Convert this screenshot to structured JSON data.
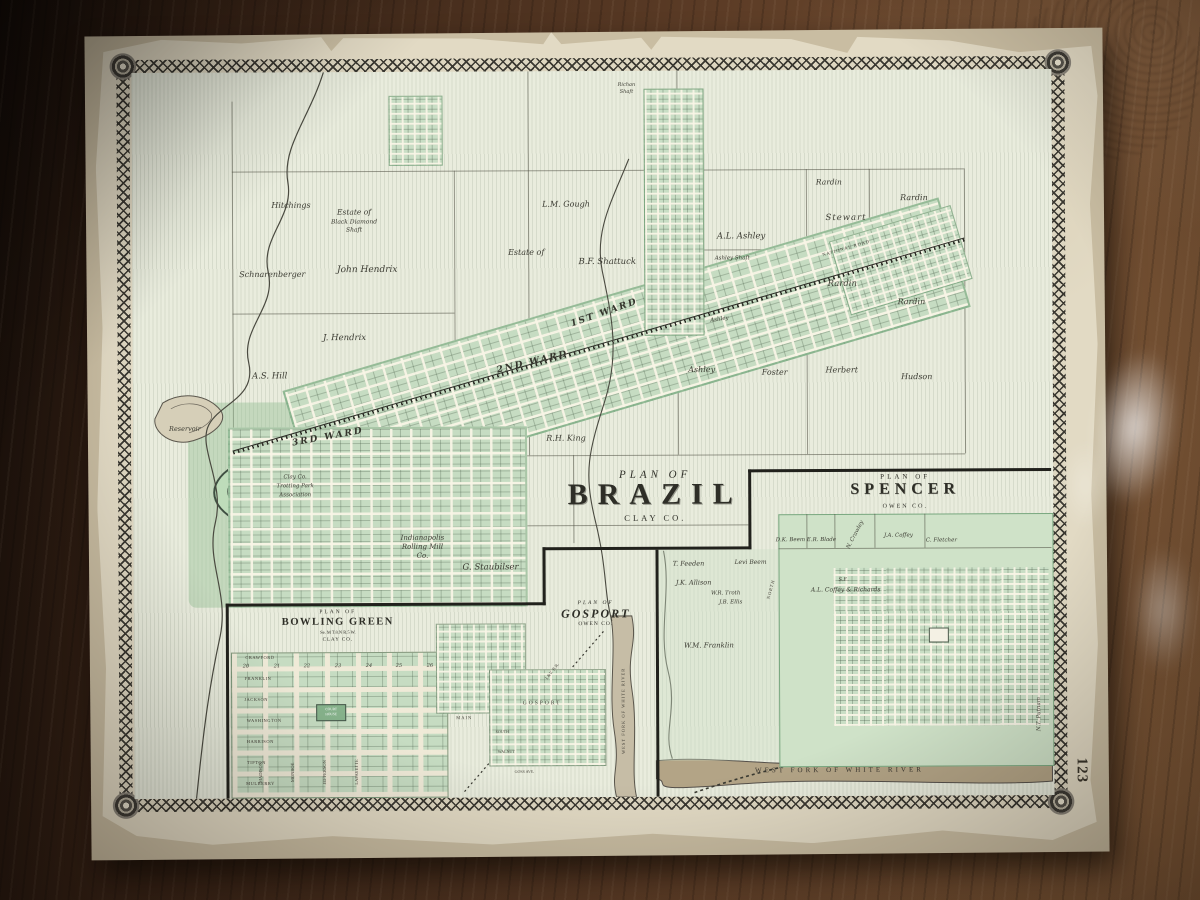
{
  "photo": {
    "page_number": "123"
  },
  "brazil": {
    "title_small": "PLAN OF",
    "title": "BRAZIL",
    "county": "CLAY CO.",
    "road": "NATIONAL ROAD",
    "wards": {
      "first": "1ST WARD",
      "second": "2ND WARD",
      "third": "3RD WARD"
    },
    "parcels": {
      "hitchings": "Hitchings",
      "estate1": "Estate of",
      "estate2": "Black Diamond",
      "estate3": "Shaft",
      "schnarenberger": "Schnarenberger",
      "john_hendrix": "John Hendrix",
      "j_hendrix": "J. Hendrix",
      "as_hill": "A.S. Hill",
      "lm_gough": "L.M. Gough",
      "estate_of": "Estate of",
      "bf_shattuck": "B.F. Shattuck",
      "al_ashley": "A.L. Ashley",
      "ashley_shaft": "Ashley Shaft",
      "ashley_road": "Ashley",
      "rardin_a": "Rardin",
      "rardin_b": "Rardin",
      "stewart": "Stewart",
      "rardin_c": "Rardin",
      "rardin_d": "Rardin",
      "ashley": "Ashley",
      "foster": "Foster",
      "herbert": "Herbert",
      "hudson": "Hudson",
      "rh_king": "R.H. King",
      "staubilser": "G. Staubilser"
    },
    "features": {
      "reservoir": "Reservoir",
      "trotting1": "Clay Co.",
      "trotting2": "Trotting Park",
      "trotting3": "Association",
      "mill1": "Indianapolis",
      "mill2": "Rolling Mill",
      "mill3": "Co.",
      "richan1": "Richan",
      "richan2": "Shaft"
    }
  },
  "spencer": {
    "title_small": "PLAN OF",
    "title": "SPENCER",
    "county": "OWEN CO.",
    "owners": {
      "dk_beem": "D.K. Beem",
      "er_blade": "E.R. Blade",
      "n_crawley": "N. Crawley",
      "ja_coffey": "J.A. Coffey",
      "c_fletcher": "C. Fletcher",
      "t_feeden": "T. Feeden",
      "levi_beem": "Levi Beem",
      "jk_allison": "J.K. Allison",
      "wr_troth": "W.R. Troth",
      "jb_ellis": "J.B. Ellis",
      "se": "S.E.",
      "coffey_richards": "A.L. Coffey & Richards",
      "wm_franklin": "W.M. Franklin",
      "nt_putnam": "N.T. Putnam"
    },
    "street_north": "NORTH",
    "river": "WEST FORK OF WHITE RIVER"
  },
  "bowling_green": {
    "title_small": "PLAN OF",
    "title": "BOWLING GREEN",
    "township": "Se. M T.8.N R.5 W.",
    "county": "CLAY CO.",
    "streets_h": [
      "CRAWFORD",
      "FRANKLIN",
      "JACKSON",
      "WASHINGTON",
      "HARRISON",
      "TIPTON",
      "MULBERRY"
    ],
    "streets_v": [
      "MADISON",
      "MONROE",
      "JEFFERSON",
      "LAFAYETTE"
    ],
    "blocks": [
      "20",
      "21",
      "22",
      "23",
      "24",
      "25",
      "26"
    ],
    "courthouse1": "COURT",
    "courthouse2": "HOUSE"
  },
  "gosport": {
    "title_small": "PLAN OF",
    "title": "GOSPORT",
    "county": "OWEN CO.",
    "label": "GOSPORT",
    "main": "MAIN",
    "south": "SOUTH",
    "walnut": "WALNUT",
    "goss": "GOSS AVE.",
    "river": "WEST FORK OF WHITE RIVER",
    "railroad": "I.&V. R.R."
  }
}
